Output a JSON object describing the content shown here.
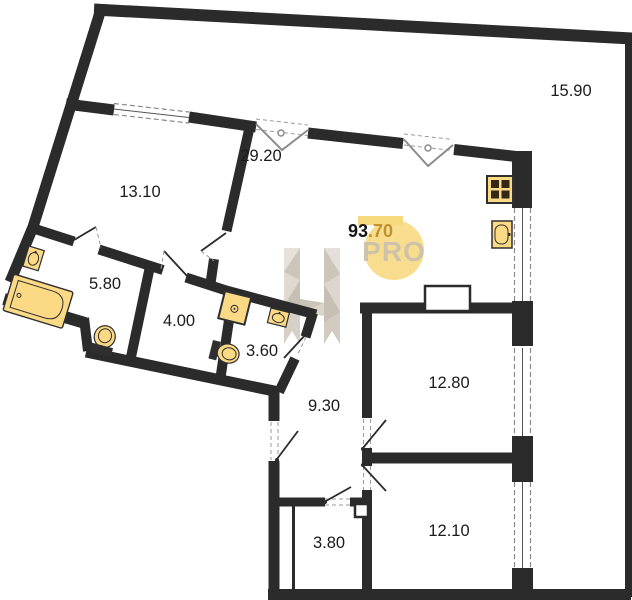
{
  "rooms": {
    "living": "29.20",
    "bedroom_left": "13.10",
    "terrace": "15.90",
    "bathroom": "5.80",
    "storage": "4.00",
    "wc": "3.60",
    "hallway": "9.30",
    "bedroom_right_top": "12.80",
    "bedroom_right_bottom": "12.10",
    "entry": "3.80"
  },
  "watermark": {
    "area_black": "93",
    "area_gold": ".70",
    "brand": "PRO"
  },
  "fixtures": {
    "bathtub": "bathtub-icon",
    "bathroom_sink": "sink-icon",
    "bathroom_toilet": "toilet-icon",
    "wc_washing_machine": "washing-machine-icon",
    "wc_sink": "sink-icon",
    "wc_toilet": "toilet-icon",
    "kitchen_stove": "stove-icon",
    "kitchen_sink": "sink-icon"
  },
  "colors": {
    "wall": "#2b2b2b",
    "fixture_fill": "#FBD985",
    "accent_yellow": "#F6D87D",
    "gold_text": "#C0922E",
    "watermark_grey": "#D7D0C6"
  }
}
